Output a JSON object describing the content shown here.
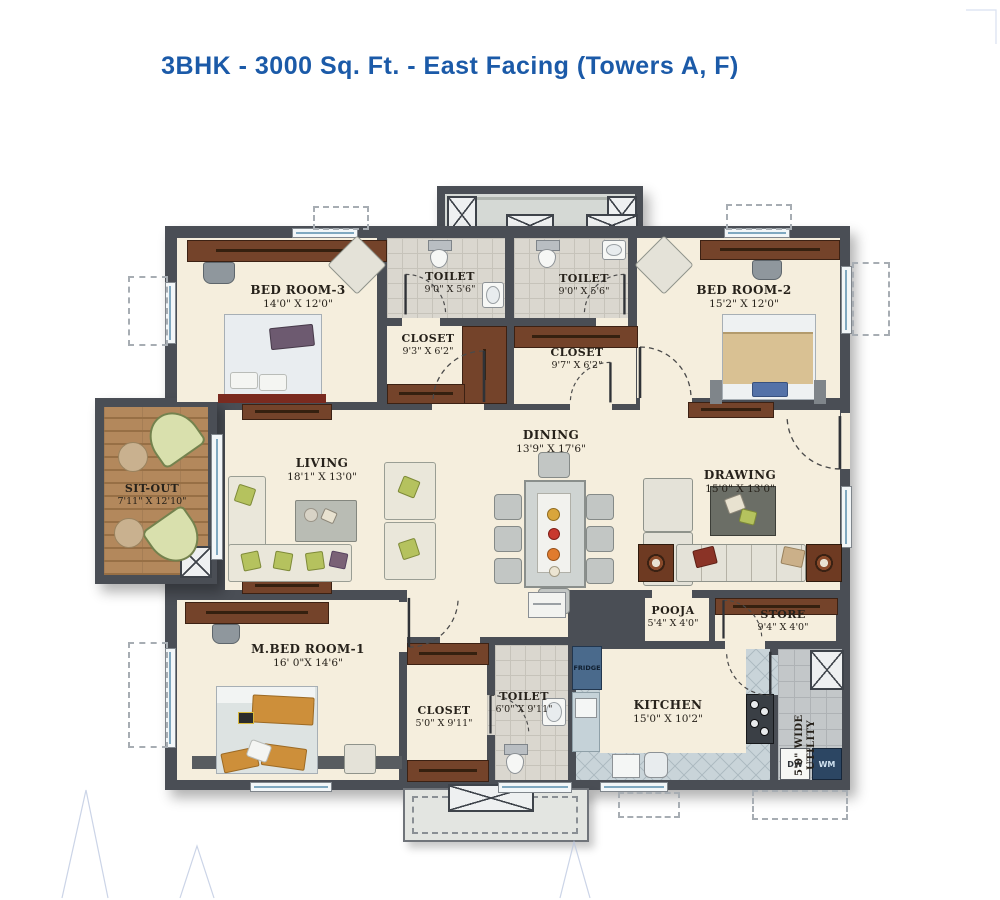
{
  "title": "3BHK - 3000 Sq. Ft. - East Facing (Towers A, F)",
  "colors": {
    "title_blue": "#1b5aa8",
    "wall": "#4a4e55",
    "floor_cream": "#f5eedd",
    "wood_brown": "#74432a",
    "tile_gray": "#dad7cf",
    "kitchen_tile": "#c9d4d9",
    "deck_wood": "#b3885c",
    "fridge_blue": "#4a6a8c",
    "wm_blue": "#2c4663"
  },
  "rooms": {
    "bedroom3": {
      "name": "BED ROOM-3",
      "dims": "14'0\" X 12'0\""
    },
    "toilet_top_left": {
      "name": "TOILET",
      "dims": "9'0\" X 5'6\""
    },
    "toilet_top_right": {
      "name": "TOILET",
      "dims": "9'0\" X 5'6\""
    },
    "bedroom2": {
      "name": "BED ROOM-2",
      "dims": "15'2\" X 12'0\""
    },
    "closet_b3": {
      "name": "CLOSET",
      "dims": "9'3\" X 6'2\""
    },
    "closet_b2": {
      "name": "CLOSET",
      "dims": "9'7\" X 6'2\""
    },
    "sitout": {
      "name": "SIT-OUT",
      "dims": "7'11\" X 12'10\""
    },
    "living": {
      "name": "LIVING",
      "dims": "18'1\" X 13'0\""
    },
    "dining": {
      "name": "DINING",
      "dims": "13'9\" X 17'6\""
    },
    "drawing": {
      "name": "DRAWING",
      "dims": "15'0\" X 13'0\""
    },
    "master_bedroom": {
      "name": "M.BED ROOM-1",
      "dims": "16' 0\"X 14'6\""
    },
    "closet_master": {
      "name": "CLOSET",
      "dims": "5'0\" X 9'11\""
    },
    "toilet_master": {
      "name": "TOILET",
      "dims": "6'0\" X 9'11\""
    },
    "pooja": {
      "name": "POOJA",
      "dims": "5'4\" X 4'0\""
    },
    "store": {
      "name": "STORE",
      "dims": "9'4\" X 4'0\""
    },
    "kitchen": {
      "name": "KITCHEN",
      "dims": "15'0\" X 10'2\""
    },
    "utility": {
      "name": "5'0\" WIDE UTILITY"
    }
  },
  "appliances": {
    "fridge": "FRIDGE",
    "dishwasher": "DW",
    "washing_machine": "WM"
  }
}
